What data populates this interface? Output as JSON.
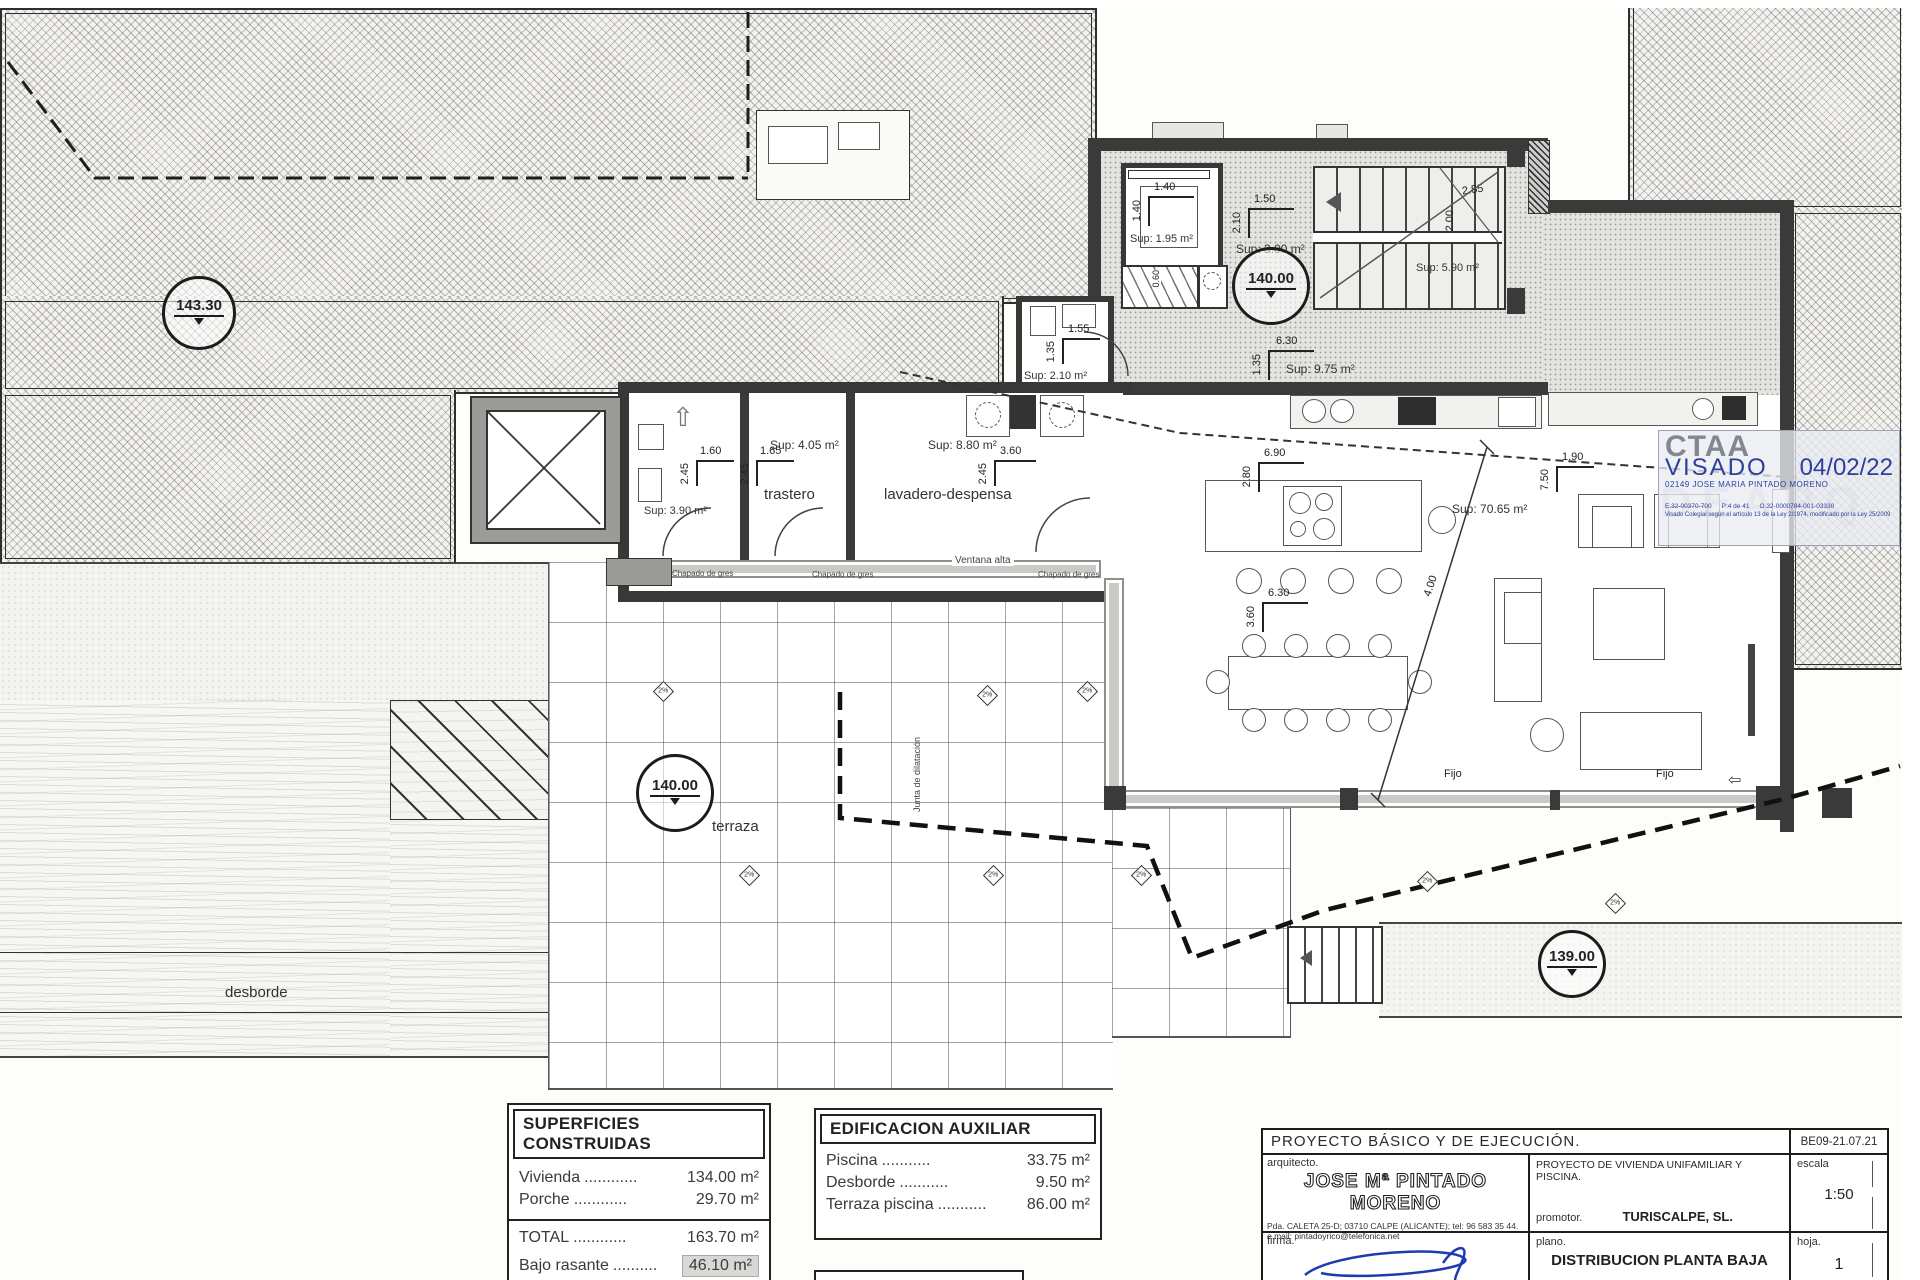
{
  "stamp": {
    "org": "CTAA",
    "visado": "VISADO",
    "date": "04/02/22",
    "subtitle": "02149 JOSE MARIA PINTADO MORENO",
    "ref1": "E.32-00370-700",
    "ref2": "P:4 de 41",
    "ref3": "O.32-0000784-001-03330",
    "legal": "Visado Colegial según el artículo 13 de la Ley 2/1974, modificado por la Ley 25/2009",
    "watermark": "DEARQ"
  },
  "markers": {
    "top": "143.30",
    "upper": "140.00",
    "terrace": "140.00",
    "lower": "139.00"
  },
  "areas": {
    "s195": "Sup: 1.95 m²",
    "s300": "Sup: 3.00 m²",
    "s590": "Sup: 5.90 m²",
    "s975": "Sup: 9.75 m²",
    "s210": "Sup: 2.10 m²",
    "s390": "Sup: 3.90 m²",
    "s405": "Sup: 4.05 m²",
    "s880": "Sup: 8.80 m²",
    "s7065": "Sup: 70.65 m²"
  },
  "rooms": {
    "trastero": "trastero",
    "lavadero": "lavadero-despensa",
    "terraza": "terraza",
    "desborde": "desborde"
  },
  "labels": {
    "ventana_alta": "Ventana alta",
    "fijo": "Fijo",
    "chapado": "Chapado de gres",
    "junta": "Junta de dilatación",
    "slope": "2%"
  },
  "dims": {
    "d060": "0.60",
    "d135": "1.35",
    "d140": "1.40",
    "d150": "1.50",
    "d155": "1.55",
    "d160": "1.60",
    "d165": "1.65",
    "d190": "1.90",
    "d200": "2.00",
    "d210": "2.10",
    "d245": "2.45",
    "d255": "2.55",
    "d280": "2.80",
    "d360": "3.60",
    "d400": "4.00",
    "d630": "6.30",
    "d690": "6.90",
    "d750": "7.50"
  },
  "tables": {
    "superficies": {
      "title": "SUPERFICIES CONSTRUIDAS",
      "rows": [
        {
          "label": "Vivienda",
          "dots": "............",
          "value": "134.00 m²"
        },
        {
          "label": "Porche",
          "dots": "............",
          "value": "29.70 m²"
        }
      ],
      "totals": [
        {
          "label": "TOTAL",
          "dots": "............",
          "value": "163.70 m²"
        },
        {
          "label": "Bajo rasante",
          "dots": "..........",
          "value": "46.10 m²"
        }
      ]
    },
    "edificacion": {
      "title": "EDIFICACION AUXILIAR",
      "rows": [
        {
          "label": "Piscina",
          "dots": "...........",
          "value": "33.75 m²"
        },
        {
          "label": "Desborde",
          "dots": "...........",
          "value": "9.50 m²"
        },
        {
          "label": "Terraza piscina",
          "dots": "...........",
          "value": "86.00 m²"
        }
      ]
    }
  },
  "title_block": {
    "header": "PROYECTO BÁSICO Y DE EJECUCIÓN.",
    "code": "BE09-21.07.21",
    "arquitecto_label": "arquitecto.",
    "arquitecto": "JOSE Mª PINTADO MORENO",
    "address": "Pda. CALETA 25-D; 03710 CALPE (ALICANTE); tel: 96 583 35 44.",
    "email": "e.mail: pintadoyrico@telefonica.net",
    "project": "PROYECTO DE VIVIENDA UNIFAMILIAR Y PISCINA.",
    "promotor_label": "promotor.",
    "promotor": "TURISCALPE, SL.",
    "escala_label": "escala",
    "escala_value": "1:50",
    "firma_label": "firma.",
    "plano_label": "plano.",
    "plano_value": "DISTRIBUCION PLANTA BAJA",
    "hoja_label": "hoja.",
    "hoja_value": "1"
  }
}
